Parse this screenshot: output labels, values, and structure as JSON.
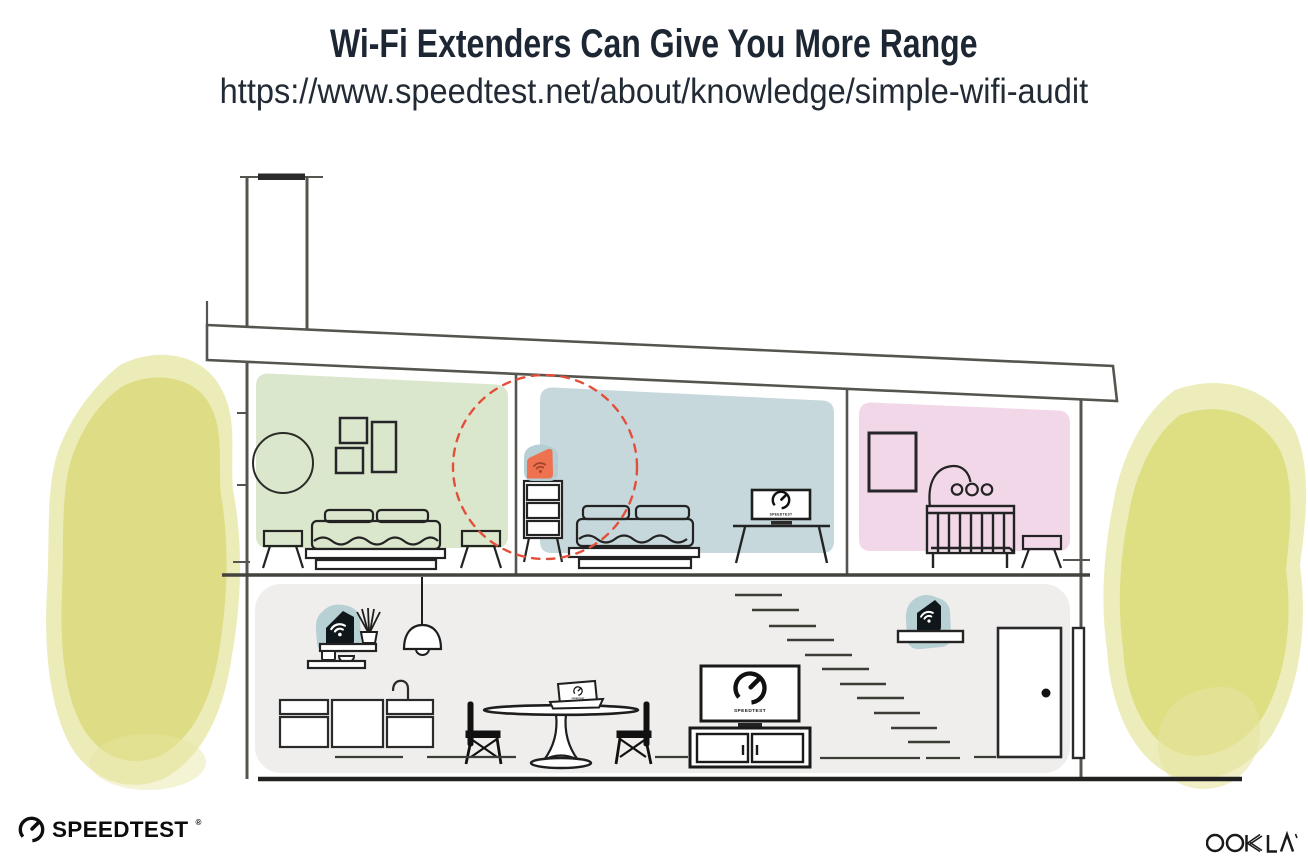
{
  "header": {
    "title": "Wi-Fi Extenders Can Give You More Range",
    "url": "https://www.speedtest.net/about/knowledge/simple-wifi-audit"
  },
  "screens": {
    "tv_upstairs_label": "SPEEDTEST",
    "tv_downstairs_label": "SPEEDTEST",
    "laptop_label": "SPEEDTEST"
  },
  "footer": {
    "speedtest_wordmark": "SPEEDTEST",
    "registered_mark": "®",
    "ookla_wordmark": "OOKLA"
  },
  "colors": {
    "room_green": "#dbe7cc",
    "room_blue": "#c6d8db",
    "room_pink": "#f1d7e7",
    "lower_floor": "#efeeec",
    "device_teal": "#b3cdd3",
    "extender_orange": "#ee7150",
    "range_dashed_red": "#e2503c",
    "watercolor_inner": "#dcdb7b",
    "watercolor_outer": "#e6e5a0"
  }
}
